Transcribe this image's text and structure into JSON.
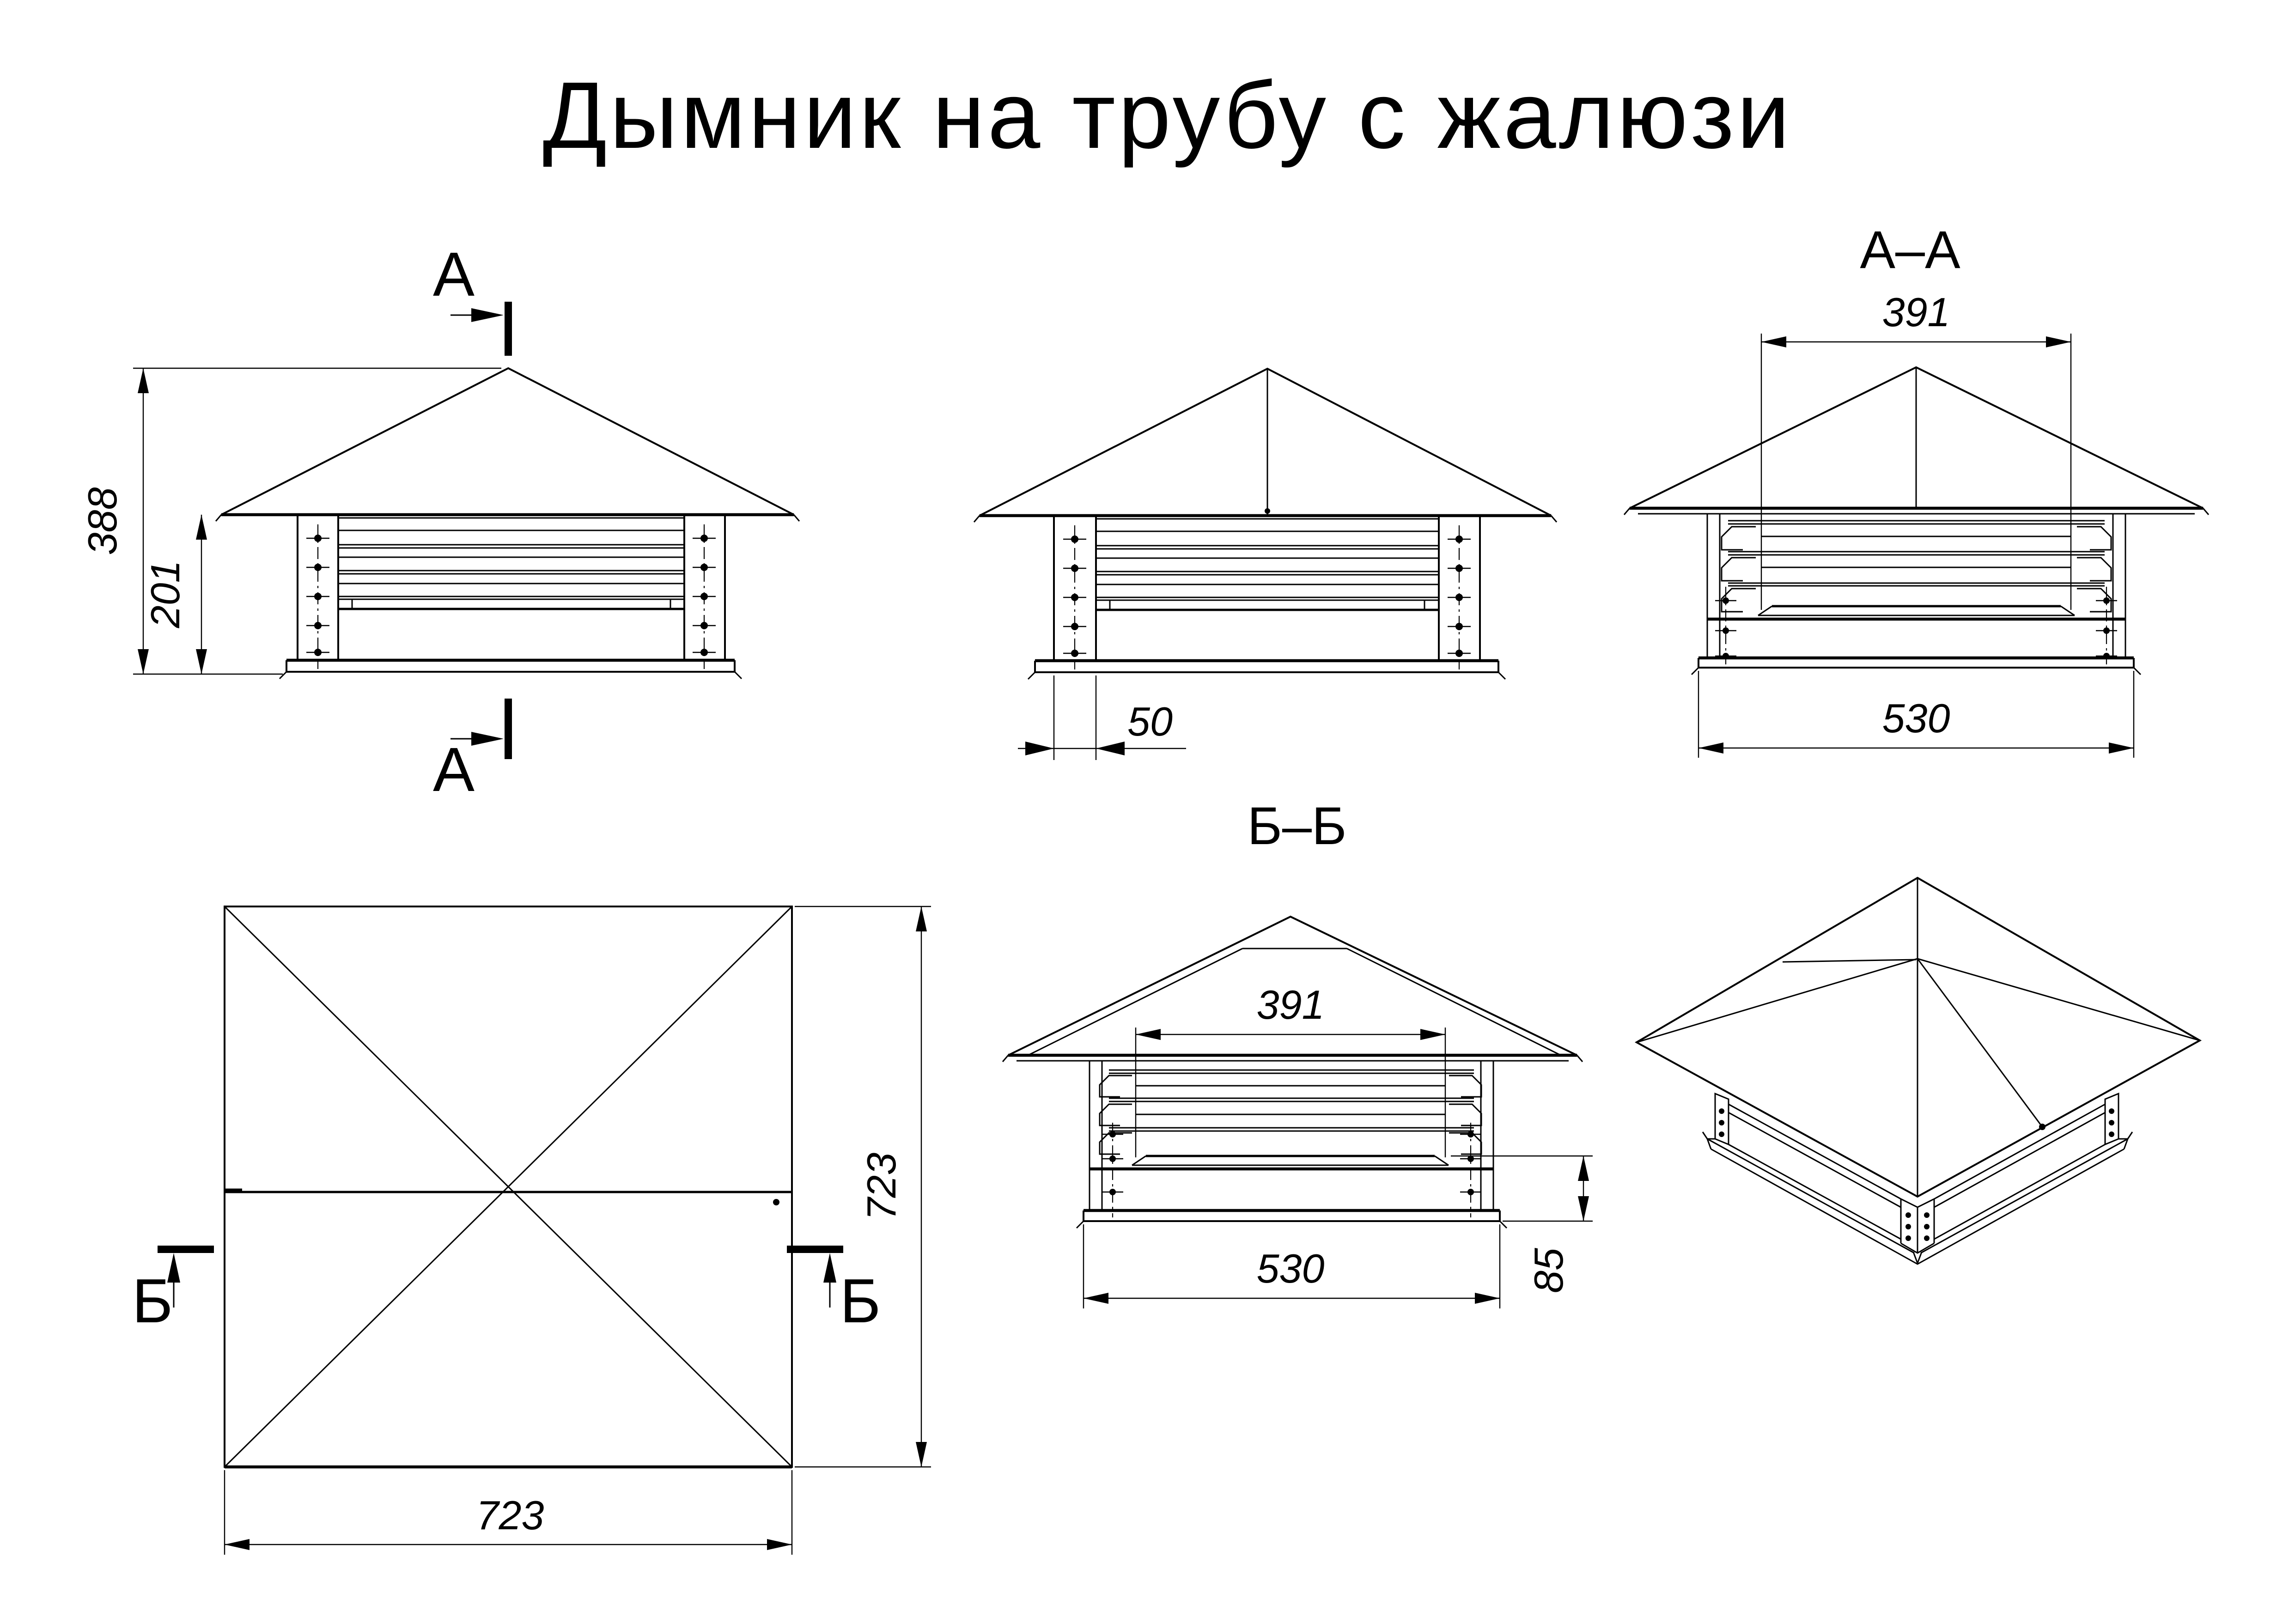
{
  "page": {
    "title": "Дымник на трубу с жалюзи",
    "background": "#ffffff",
    "ink": "#000000"
  },
  "views": {
    "front_view": {
      "section_label_top": "А",
      "section_label_bottom": "А",
      "dim_overall_height": "388",
      "dim_body_height": "201"
    },
    "side_view": {
      "dim_post_width": "50"
    },
    "section_a_a": {
      "title": "А–А",
      "dim_inner_width": "391",
      "dim_base_width": "530"
    },
    "plan_view": {
      "section_label_left": "Б",
      "section_label_right": "Б",
      "dim_width": "723",
      "dim_height": "723"
    },
    "section_b_b": {
      "title": "Б–Б",
      "dim_inner_width": "391",
      "dim_base_width": "530",
      "dim_skirt_height": "85"
    }
  }
}
